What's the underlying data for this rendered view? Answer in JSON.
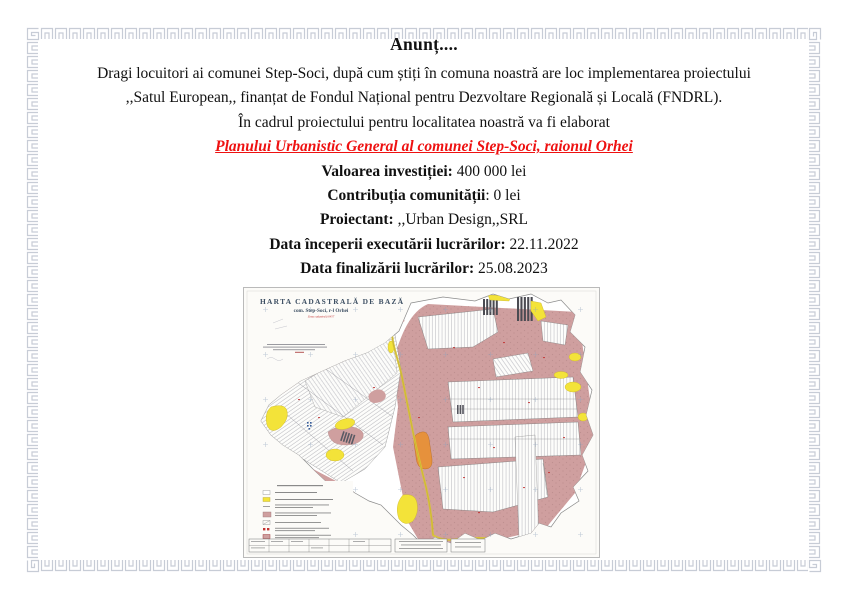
{
  "page": {
    "background": "#ffffff",
    "border_color": "#c7ccd6"
  },
  "announcement": {
    "title": "Anunț....",
    "line1": "Dragi locuitori ai comunei Step-Soci, după cum știți în comuna noastră are loc implementarea proiectului",
    "line2": ",,Satul European,, finanțat de Fondul Național pentru Dezvoltare Regională și Locală (FNDRL).",
    "line3": "În cadrul proiectului pentru localitatea noastră va fi elaborat",
    "highlight": "Planului Urbanistic General al comunei Step-Soci, raionul Orhei",
    "highlight_color": "#ee1111",
    "details": [
      {
        "label": "Valoarea investiției:",
        "value": " 400 000 lei"
      },
      {
        "label": "Contribuția comunității",
        "value": ": 0 lei"
      },
      {
        "label": "Proiectant:",
        "value": " ,,Urban Design,,SRL"
      },
      {
        "label": "Data începerii executării lucrărilor:",
        "value": " 22.11.2022"
      },
      {
        "label": "Data finalizării lucrărilor:",
        "value": " 25.08.2023"
      }
    ]
  },
  "map": {
    "title": "HARTA CADASTRALĂ DE BAZĂ",
    "subtitle": "com. Step-Soci, r-l Orhei",
    "note": "Zona cadastrală 6457",
    "colors": {
      "parcel_pink": "#cf9f9f",
      "field_yellow": "#f3e339",
      "highlight_orange": "#e6913c",
      "title_ink": "#3d4f63"
    }
  }
}
